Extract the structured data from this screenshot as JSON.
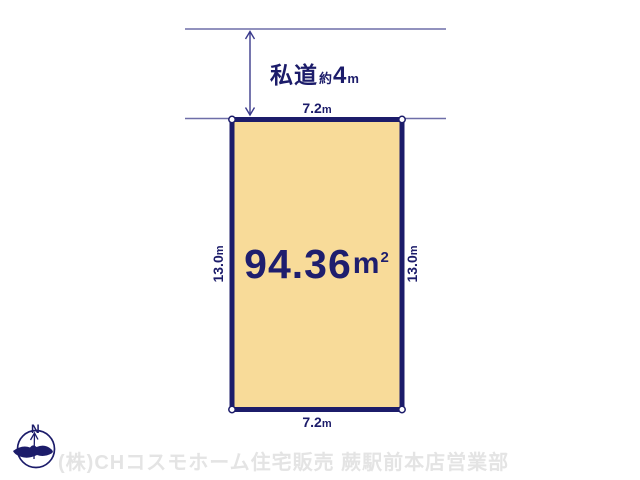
{
  "road": {
    "label_name": "私道",
    "label_approx": "約",
    "label_value": "4",
    "label_unit": "m"
  },
  "plot": {
    "area_value": "94.36",
    "area_unit": "m",
    "area_exponent": "2",
    "width_top_value": "7.2",
    "width_top_unit": "m",
    "width_bottom_value": "7.2",
    "width_bottom_unit": "m",
    "depth_left_value": "13.0",
    "depth_left_unit": "m",
    "depth_right_value": "13.0",
    "depth_right_unit": "m"
  },
  "compass": {
    "north": "N"
  },
  "footer": {
    "company": "(株)CHコスモホーム住宅販売 蕨駅前本店営業部"
  },
  "colors": {
    "plot_fill": "#F8DB99",
    "outline_navy": "#1C1C6A",
    "boundary_slate": "#6E6EA8",
    "watermark_gray": "#E4E4E4"
  }
}
